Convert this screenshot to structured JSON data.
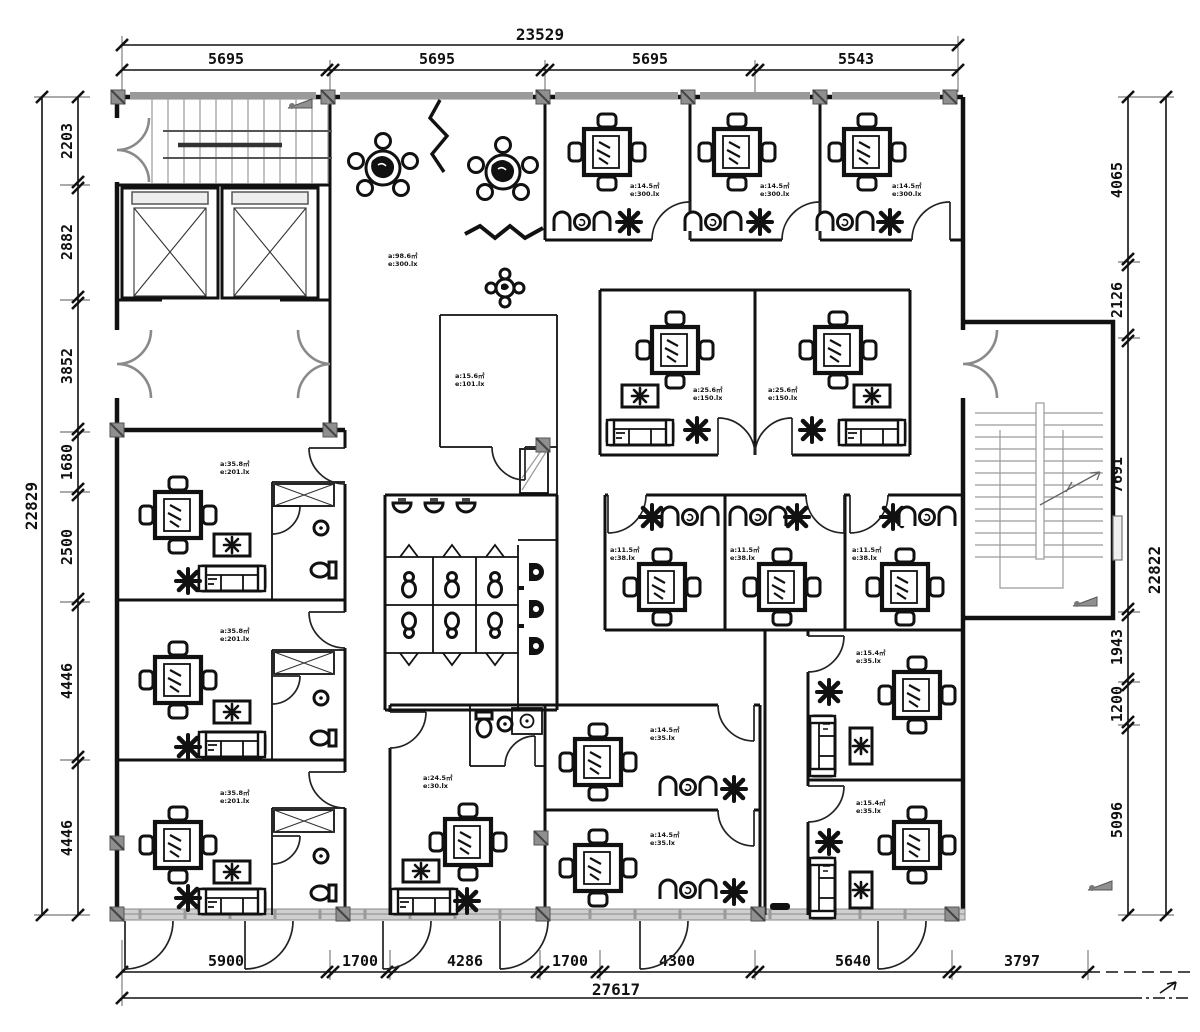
{
  "drawing": {
    "type": "office floor plan",
    "colors": {
      "wall": "#111111",
      "gray": "#8f8f8f",
      "window_band": "#cfcfcf",
      "stair_line": "#9a9a9a"
    }
  },
  "dims": {
    "top": {
      "total": "23529",
      "segments": [
        "5695",
        "5695",
        "5695",
        "5543"
      ]
    },
    "left": {
      "total": "22829",
      "segments": [
        "2203",
        "2882",
        "3852",
        "1680",
        "2500",
        "4446",
        "4446"
      ]
    },
    "right": {
      "total": "22822",
      "segments": [
        "4065",
        "2126",
        "7691",
        "1943",
        "1200",
        "5096"
      ]
    },
    "bottom": {
      "total": "27617",
      "segments": [
        "5900",
        "1700",
        "4286",
        "1700",
        "4300",
        "5640",
        "3797"
      ]
    }
  },
  "labels": {
    "lounge": {
      "l1": "a:98.6㎡",
      "l2": "e:300.lx"
    },
    "small_room": {
      "l1": "a:15.6㎡",
      "l2": "e:101.lx"
    },
    "suite": {
      "l1": "a:35.8㎡",
      "l2": "e:201.lx"
    },
    "office_top": {
      "l1": "a:14.5㎡",
      "l2": "e:300.lx"
    },
    "mid_room": {
      "l1": "a:25.6㎡",
      "l2": "e:150.lx"
    },
    "mid_band": {
      "l1": "a:11.5㎡",
      "l2": "e:38.lx"
    },
    "big_room": {
      "l1": "a:24.5㎡",
      "l2": "e:30.lx"
    },
    "bottom_mid": {
      "l1": "a:14.5㎡",
      "l2": "e:35.lx"
    },
    "bottom_right": {
      "l1": "a:15.4㎡",
      "l2": "e:35.lx"
    }
  }
}
